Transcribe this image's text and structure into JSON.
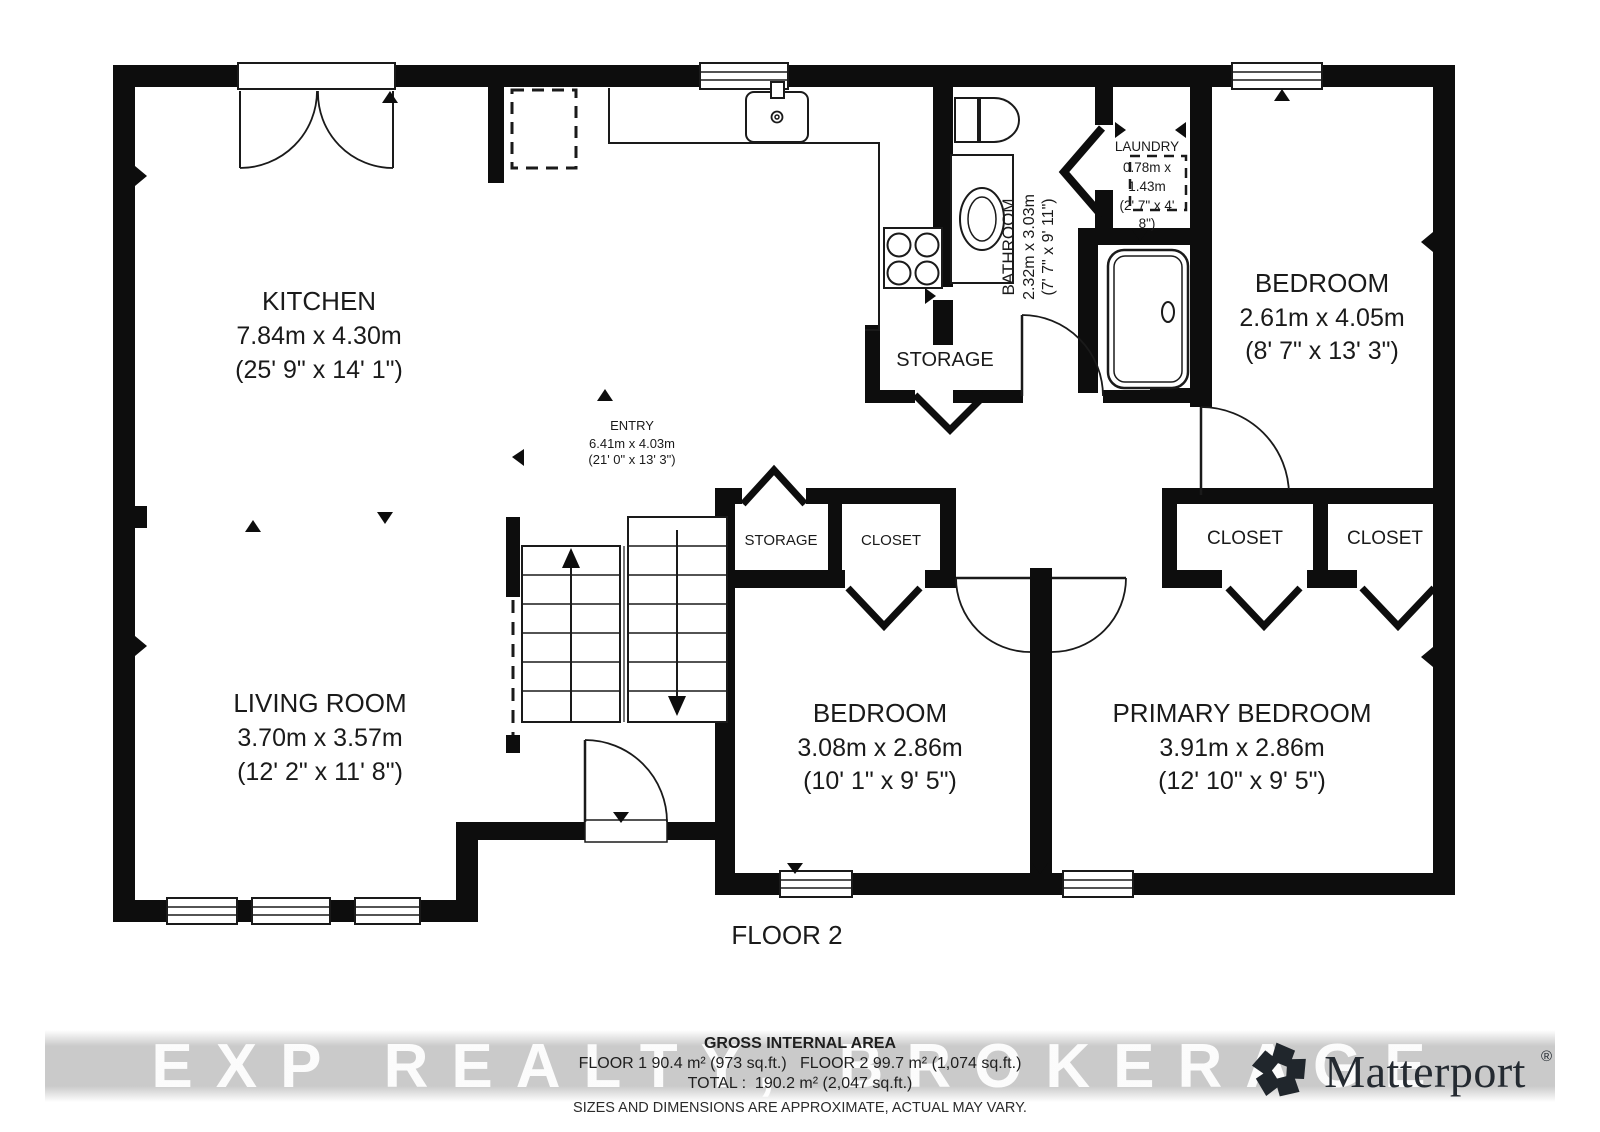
{
  "floor_label": "FLOOR 2",
  "watermark": {
    "text": "EXP REALTY, BROKERAGE"
  },
  "rooms": {
    "kitchen": {
      "name": "KITCHEN",
      "dim_m": "7.84m x 4.30m",
      "dim_ft": "(25' 9\" x 14' 1\")"
    },
    "entry": {
      "name": "ENTRY",
      "dim_m": "6.41m x 4.03m",
      "dim_ft": "(21' 0\" x 13' 3\")"
    },
    "bathroom": {
      "name": "BATHROOM",
      "dim_m": "2.32m x 3.03m",
      "dim_ft": "(7' 7\" x 9' 11\")"
    },
    "laundry": {
      "name": "LAUNDRY",
      "dim_lines": [
        "0.78m x",
        "1.43m",
        "(2' 7\" x 4'",
        "8\")"
      ]
    },
    "bedroom_top": {
      "name": "BEDROOM",
      "dim_m": "2.61m x 4.05m",
      "dim_ft": "(8' 7\" x 13' 3\")"
    },
    "living_room": {
      "name": "LIVING ROOM",
      "dim_m": "3.70m x 3.57m",
      "dim_ft": "(12' 2\" x 11' 8\")"
    },
    "bedroom_mid": {
      "name": "BEDROOM",
      "dim_m": "3.08m x 2.86m",
      "dim_ft": "(10' 1\" x 9' 5\")"
    },
    "primary_bedroom": {
      "name": "PRIMARY BEDROOM",
      "dim_m": "3.91m x 2.86m",
      "dim_ft": "(12' 10\" x 9' 5\")"
    },
    "storage_kitchen": "STORAGE",
    "storage_hall": "STORAGE",
    "closet_hall": "CLOSET",
    "closet_a": "CLOSET",
    "closet_b": "CLOSET"
  },
  "footer": {
    "area_title": "GROSS INTERNAL AREA",
    "area_line1": "FLOOR 1 90.4 m² (973 sq.ft.)   FLOOR 2 99.7 m² (1,074 sq.ft.)",
    "area_line2": "TOTAL :  190.2 m² (2,047 sq.ft.)",
    "disclaimer": "SIZES AND DIMENSIONS ARE APPROXIMATE, ACTUAL MAY VARY."
  },
  "brand": {
    "name": "Matterport",
    "reg": "®"
  },
  "colors": {
    "wall": "#0d0d0d",
    "line": "#1a1a1a",
    "text": "#1a1a1a"
  }
}
